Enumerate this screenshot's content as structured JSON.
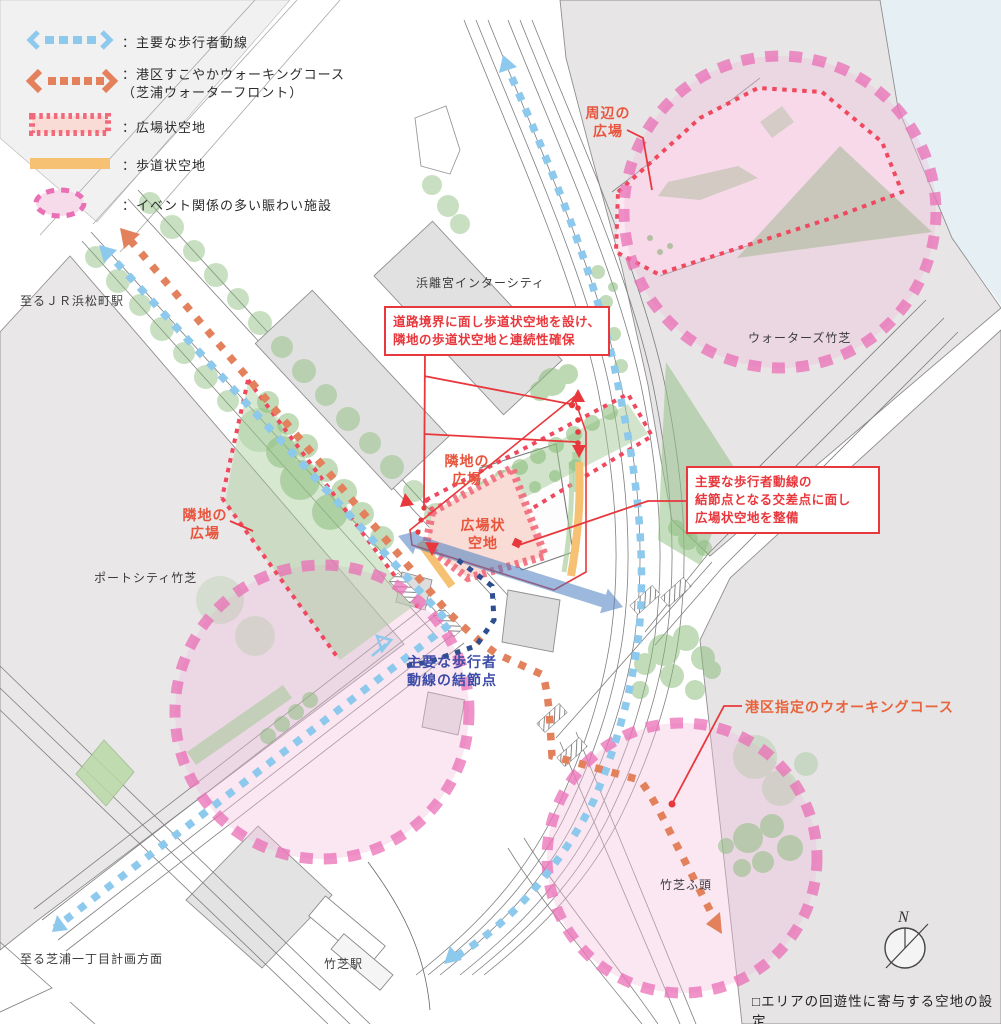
{
  "legend": {
    "items": [
      {
        "swatch": "blue-dashed-arrow",
        "label": "：主要な歩行者動線"
      },
      {
        "swatch": "orange-dotted-arrow",
        "label": "：港区すこやかウォーキングコース\n（芝浦ウォーターフロント）"
      },
      {
        "swatch": "plaza-open-space-bar",
        "label": "：広場状空地"
      },
      {
        "swatch": "sidewalk-open-space-bar",
        "label": "：歩道状空地"
      },
      {
        "swatch": "event-facility-ellipse",
        "label": "：イベント関係の多い賑わい施設"
      }
    ]
  },
  "callouts": {
    "sidewalk_continuity": "道路境界に面し歩道状空地を設け、\n隣地の歩道状空地と連続性確保",
    "plaza_at_node": "主要な歩行者動線の\n結節点となる交差点に面し\n広場状空地を整備"
  },
  "map_labels": {
    "shuhen_no_hiroba": "周辺の\n広場",
    "waters_takeshiba": "ウォーターズ竹芝",
    "hamarikyu_intercity": "浜離宮インターシティ",
    "to_jr_hamamatsucho": "至るＪＲ浜松町駅",
    "rinchi_no_hiroba_left": "隣地の\n広場",
    "rinchi_no_hiroba_center": "隣地の\n広場",
    "hirobajo_kuchi": "広場状\n空地",
    "port_city_takeshiba": "ポートシティ竹芝",
    "pedestrian_node": "主要な歩行者\n動線の結節点",
    "minato_walking_course": "港区指定のウオーキングコース",
    "takeshiba_futo": "竹芝ふ頭",
    "to_shibaura_itchome": "至る芝浦一丁目計画方面",
    "takeshiba_station": "竹芝駅"
  },
  "caption": "□エリアの回遊性に寄与する空地の設定",
  "compass": {
    "label": "N"
  },
  "colors": {
    "pedestrian_flow_blue": "#8DC9EC",
    "walking_course_orange": "#E2815B",
    "plaza_stripe_pink": "#F2697B",
    "plaza_fill_pink": "#F9DCD5",
    "sidewalk_orange": "#F7C173",
    "event_circle_magenta": "#EA6FB5",
    "event_circle_fill": "#F1BFDD",
    "annotation_red": "#E8383D",
    "node_text_blue": "#3D4CA8",
    "tree_green": "#86BB77",
    "parcel_gray": "#E7E5E6",
    "water_blue": "#E6EFF4"
  }
}
